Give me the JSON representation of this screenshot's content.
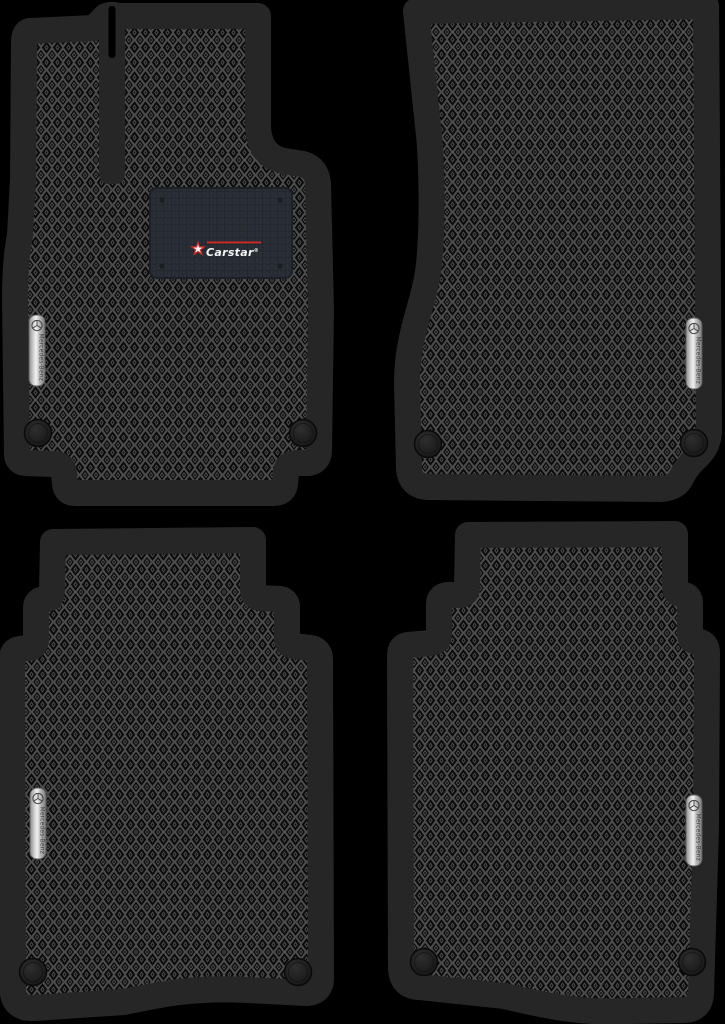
{
  "canvas": {
    "width": 725,
    "height": 1024,
    "background": "#000000"
  },
  "colors": {
    "mat_border": "#262626",
    "pattern_background": "#0a0a0a",
    "pattern_line": "#4c4c4c",
    "slot_gap": "#000000",
    "heel_pad_base": "#2a2f38",
    "heel_pad_dot": "#21262d",
    "heel_pad_edge": "#1d2127",
    "rivet": "#1a1e24",
    "logo_red": "#cf2a27",
    "logo_text": "#f5f5f5",
    "badge_outline": "#5a5d60",
    "badge_text": "#3f3f3f",
    "fastener": "#1b1b1b"
  },
  "branding": {
    "carstar": {
      "label": "Carstar",
      "registered": "®",
      "icon": "red-star-icon"
    },
    "mercedes": {
      "label": "Mercedes-Benz",
      "icon": "mercedes-star-icon"
    }
  },
  "mats": [
    {
      "position": "front-left",
      "role": "driver mat",
      "badge": "Mercedes-Benz",
      "heel_pad": "Carstar",
      "fastener_count": 2
    },
    {
      "position": "front-right",
      "role": "passenger mat",
      "badge": "Mercedes-Benz",
      "fastener_count": 2
    },
    {
      "position": "rear-left",
      "role": "rear mat",
      "badge": "Mercedes-Benz",
      "fastener_count": 2
    },
    {
      "position": "rear-right",
      "role": "rear mat",
      "badge": "Mercedes-Benz",
      "fastener_count": 2
    }
  ]
}
